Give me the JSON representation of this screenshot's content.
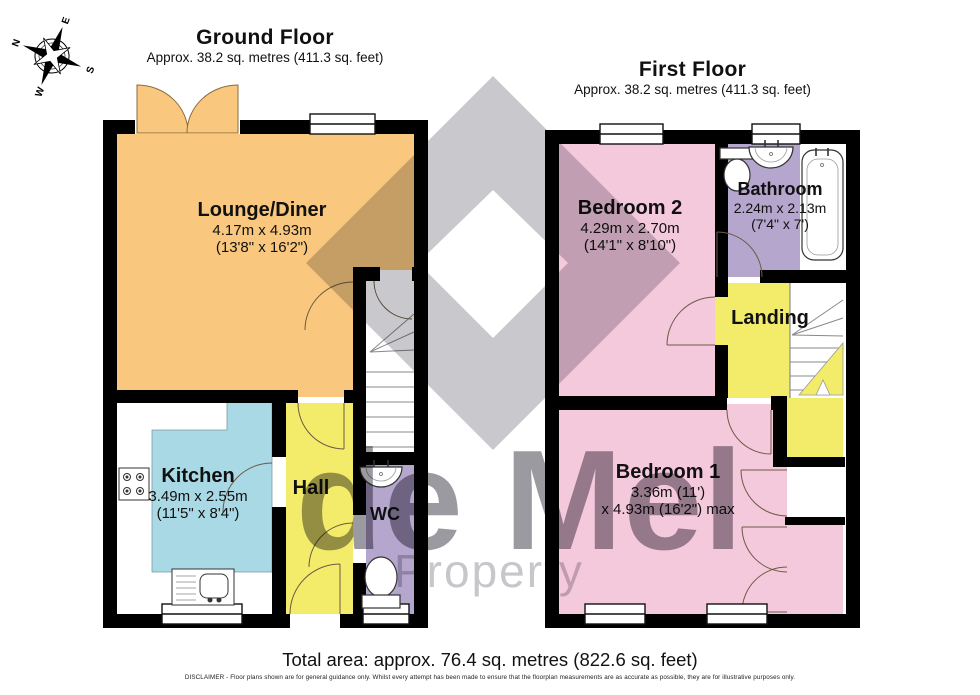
{
  "ground_floor": {
    "title": "Ground Floor",
    "subtitle": "Approx. 38.2 sq. metres (411.3 sq. feet)",
    "rooms": {
      "lounge": {
        "name": "Lounge/Diner",
        "dim_metric": "4.17m x 4.93m",
        "dim_imperial": "(13'8\" x 16'2\")"
      },
      "kitchen": {
        "name": "Kitchen",
        "dim_metric": "3.49m x 2.55m",
        "dim_imperial": "(11'5\" x 8'4\")"
      },
      "hall": {
        "name": "Hall"
      },
      "wc": {
        "name": "WC"
      }
    }
  },
  "first_floor": {
    "title": "First Floor",
    "subtitle": "Approx. 38.2 sq. metres (411.3 sq. feet)",
    "rooms": {
      "bedroom2": {
        "name": "Bedroom 2",
        "dim_metric": "4.29m x 2.70m",
        "dim_imperial": "(14'1\" x 8'10\")"
      },
      "bathroom": {
        "name": "Bathroom",
        "dim_metric": "2.24m x 2.13m",
        "dim_imperial": "(7'4\" x 7')"
      },
      "landing": {
        "name": "Landing"
      },
      "bedroom1": {
        "name": "Bedroom 1",
        "dim_line1": "3.36m (11')",
        "dim_line2": "x 4.93m (16'2\") max"
      }
    }
  },
  "compass": {
    "n": "N",
    "e": "E",
    "s": "S",
    "w": "W"
  },
  "watermark": {
    "line1": "de Mel",
    "line2": "Property"
  },
  "footer": {
    "total_area": "Total area: approx. 76.4 sq. metres (822.6 sq. feet)",
    "disclaimer": "DISCLAIMER -  Floor plans shown are for general guidance only. Whilst every attempt has been made to ensure that the floorplan measurements are as accurate as possible, they are for illustrative purposes only."
  },
  "colors": {
    "lounge": "#F9C87E",
    "kitchen": "#A9D9E5",
    "hall": "#F3EC6B",
    "wc_bath": "#B5A6CD",
    "bedroom": "#F5C9DC",
    "wall": "#000000"
  }
}
